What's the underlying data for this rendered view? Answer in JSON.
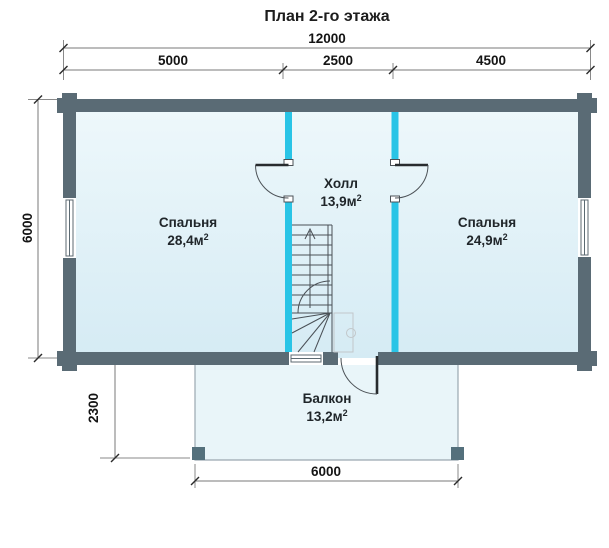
{
  "title": "План 2-го этажа",
  "dimensions": {
    "total_width": "12000",
    "left_span": "5000",
    "middle_span": "2500",
    "right_span": "4500",
    "house_depth": "6000",
    "balcony_depth": "2300",
    "balcony_width": "6000"
  },
  "rooms": {
    "bedroom_left": {
      "name": "Спальня",
      "area": "28,4м",
      "area_sup": "2"
    },
    "hall": {
      "name": "Холл",
      "area": "13,9м",
      "area_sup": "2"
    },
    "bedroom_right": {
      "name": "Спальня",
      "area": "24,9м",
      "area_sup": "2"
    },
    "balcony": {
      "name": "Балкон",
      "area": "13,2м",
      "area_sup": "2"
    }
  },
  "colors": {
    "outer_wall": "#5a6b75",
    "partition_wall": "#29c4e6",
    "room_fill_top": "#eef8fb",
    "room_fill_bottom": "#d5ebf4",
    "balcony_fill": "#e9f5f9",
    "dimension_text": "#141414"
  }
}
